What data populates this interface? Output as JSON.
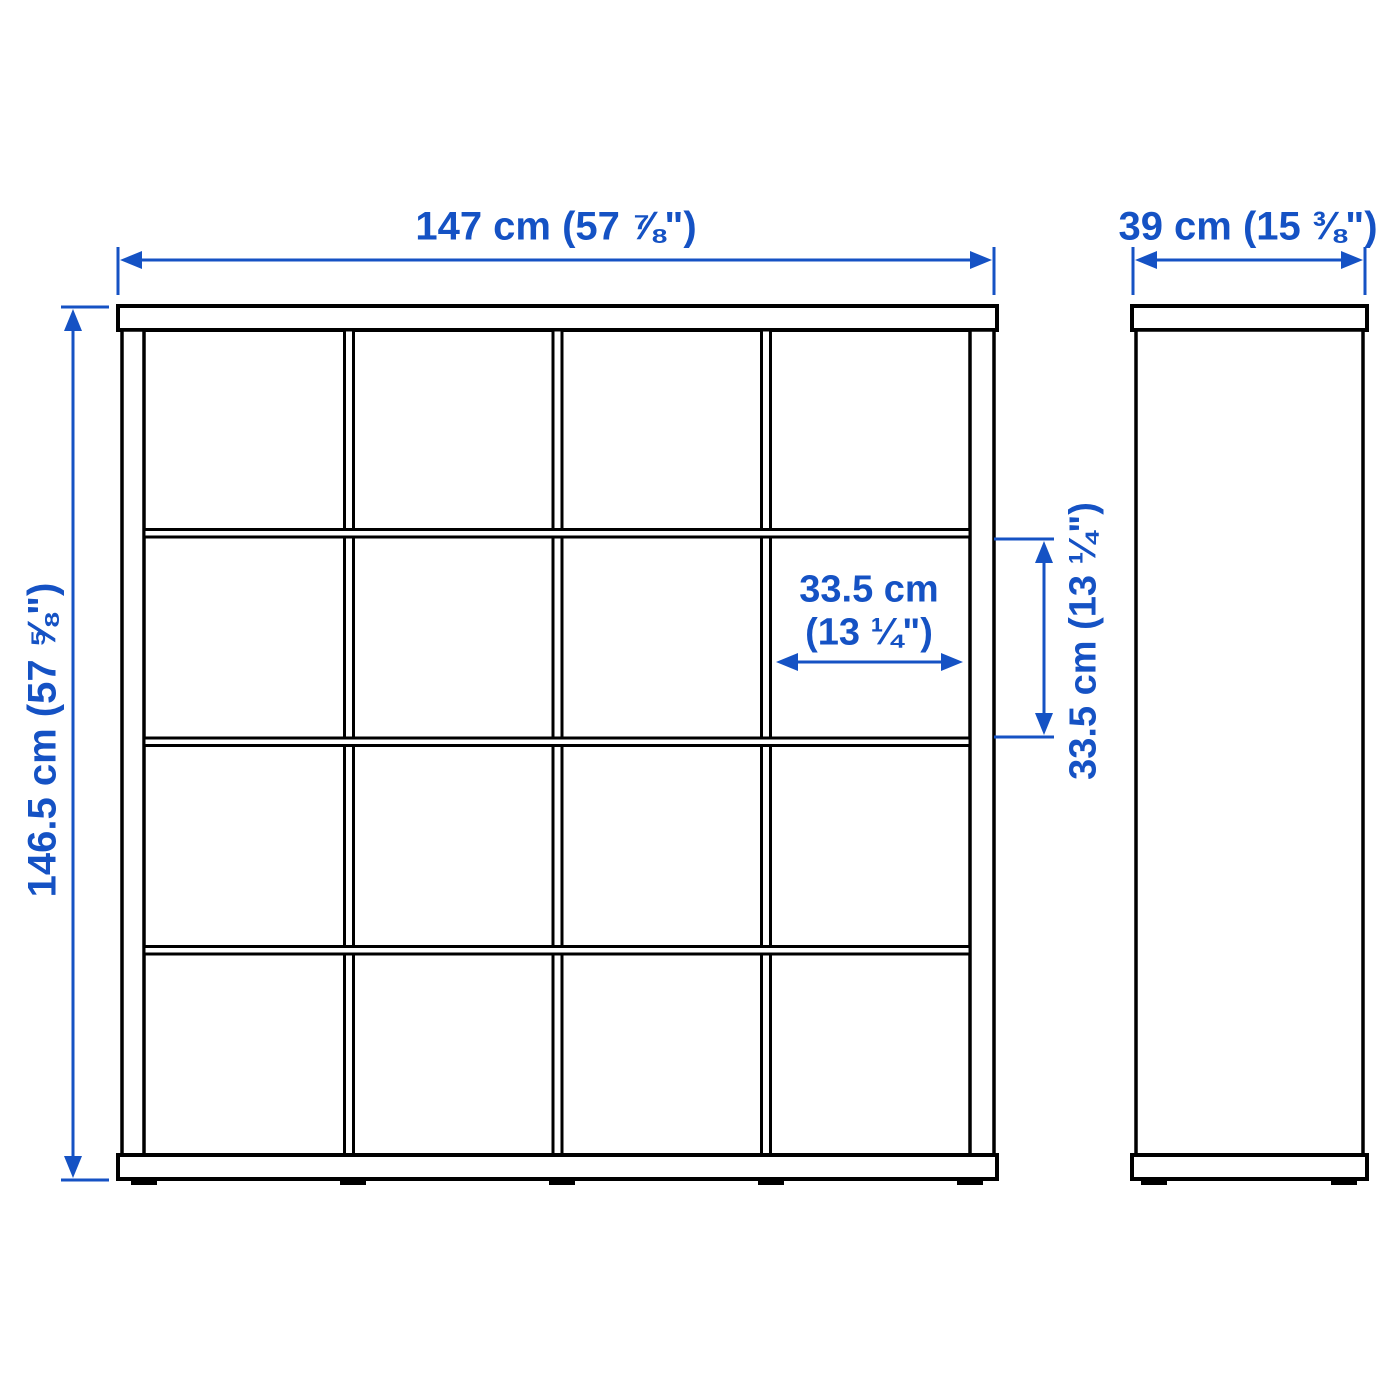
{
  "colors": {
    "dimension_blue": "#1552c4",
    "outline_black": "#000000",
    "background": "#ffffff"
  },
  "dimensions": {
    "overall_width": "147 cm (57 ⅞\")",
    "overall_depth": "39 cm (15 ⅜\")",
    "overall_height": "146.5 cm (57 ⅝\")",
    "cell_width_cm": "33.5 cm",
    "cell_width_in": "(13 ¼\")",
    "cell_height": "33.5 cm (13 ¼\")"
  },
  "structure": {
    "grid_rows": 4,
    "grid_columns": 4,
    "views": [
      "front",
      "side"
    ]
  }
}
